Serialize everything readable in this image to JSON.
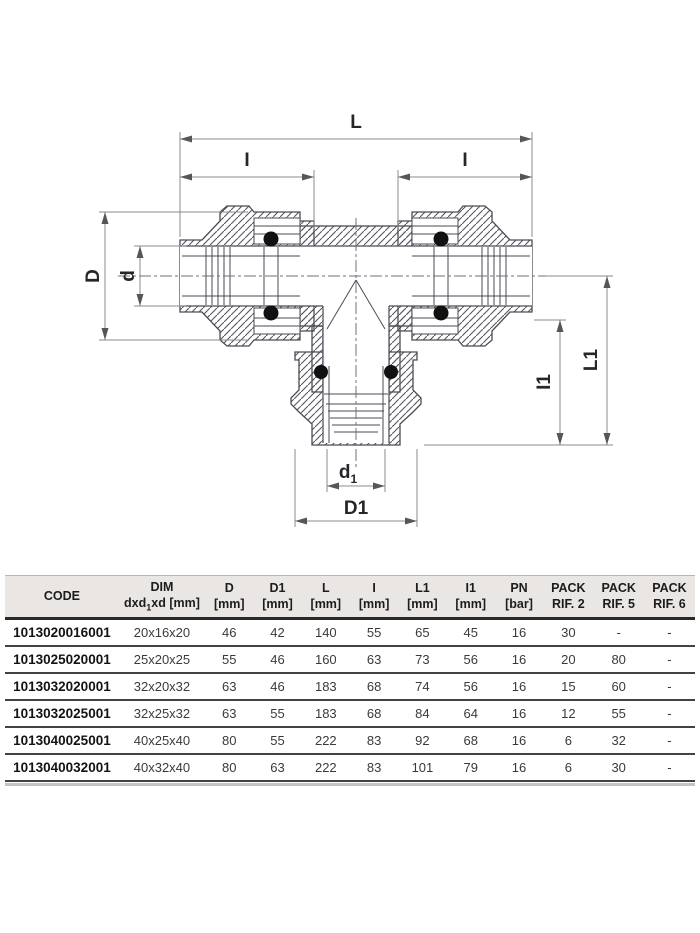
{
  "diagram": {
    "line_color": "#4a4a54",
    "dim_color": "#8b8b8e",
    "labels": {
      "L": "L",
      "I": "I",
      "D": "D",
      "d": "d",
      "L1": "L1",
      "I1": "I1",
      "d1_base": "d",
      "d1_sub": "1",
      "D1": "D1"
    }
  },
  "table": {
    "headers": [
      {
        "l1": "CODE",
        "l2": ""
      },
      {
        "l1": "DIM",
        "l2_pre": "dxd",
        "l2_sub": "1",
        "l2_post": "xd [mm]"
      },
      {
        "l1": "D",
        "l2": "[mm]"
      },
      {
        "l1": "D1",
        "l2": "[mm]"
      },
      {
        "l1": "L",
        "l2": "[mm]"
      },
      {
        "l1": "I",
        "l2": "[mm]"
      },
      {
        "l1": "L1",
        "l2": "[mm]"
      },
      {
        "l1": "I1",
        "l2": "[mm]"
      },
      {
        "l1": "PN",
        "l2": "[bar]"
      },
      {
        "l1": "PACK",
        "l2": "RIF. 2"
      },
      {
        "l1": "PACK",
        "l2": "RIF. 5"
      },
      {
        "l1": "PACK",
        "l2": "RIF. 6"
      }
    ],
    "rows": [
      [
        "1013020016001",
        "20x16x20",
        "46",
        "42",
        "140",
        "55",
        "65",
        "45",
        "16",
        "30",
        "-",
        "-"
      ],
      [
        "1013025020001",
        "25x20x25",
        "55",
        "46",
        "160",
        "63",
        "73",
        "56",
        "16",
        "20",
        "80",
        "-"
      ],
      [
        "1013032020001",
        "32x20x32",
        "63",
        "46",
        "183",
        "68",
        "74",
        "56",
        "16",
        "15",
        "60",
        "-"
      ],
      [
        "1013032025001",
        "32x25x32",
        "63",
        "55",
        "183",
        "68",
        "84",
        "64",
        "16",
        "12",
        "55",
        "-"
      ],
      [
        "1013040025001",
        "40x25x40",
        "80",
        "55",
        "222",
        "83",
        "92",
        "68",
        "16",
        "6",
        "32",
        "-"
      ],
      [
        "1013040032001",
        "40x32x40",
        "80",
        "63",
        "222",
        "83",
        "101",
        "79",
        "16",
        "6",
        "30",
        "-"
      ]
    ]
  }
}
